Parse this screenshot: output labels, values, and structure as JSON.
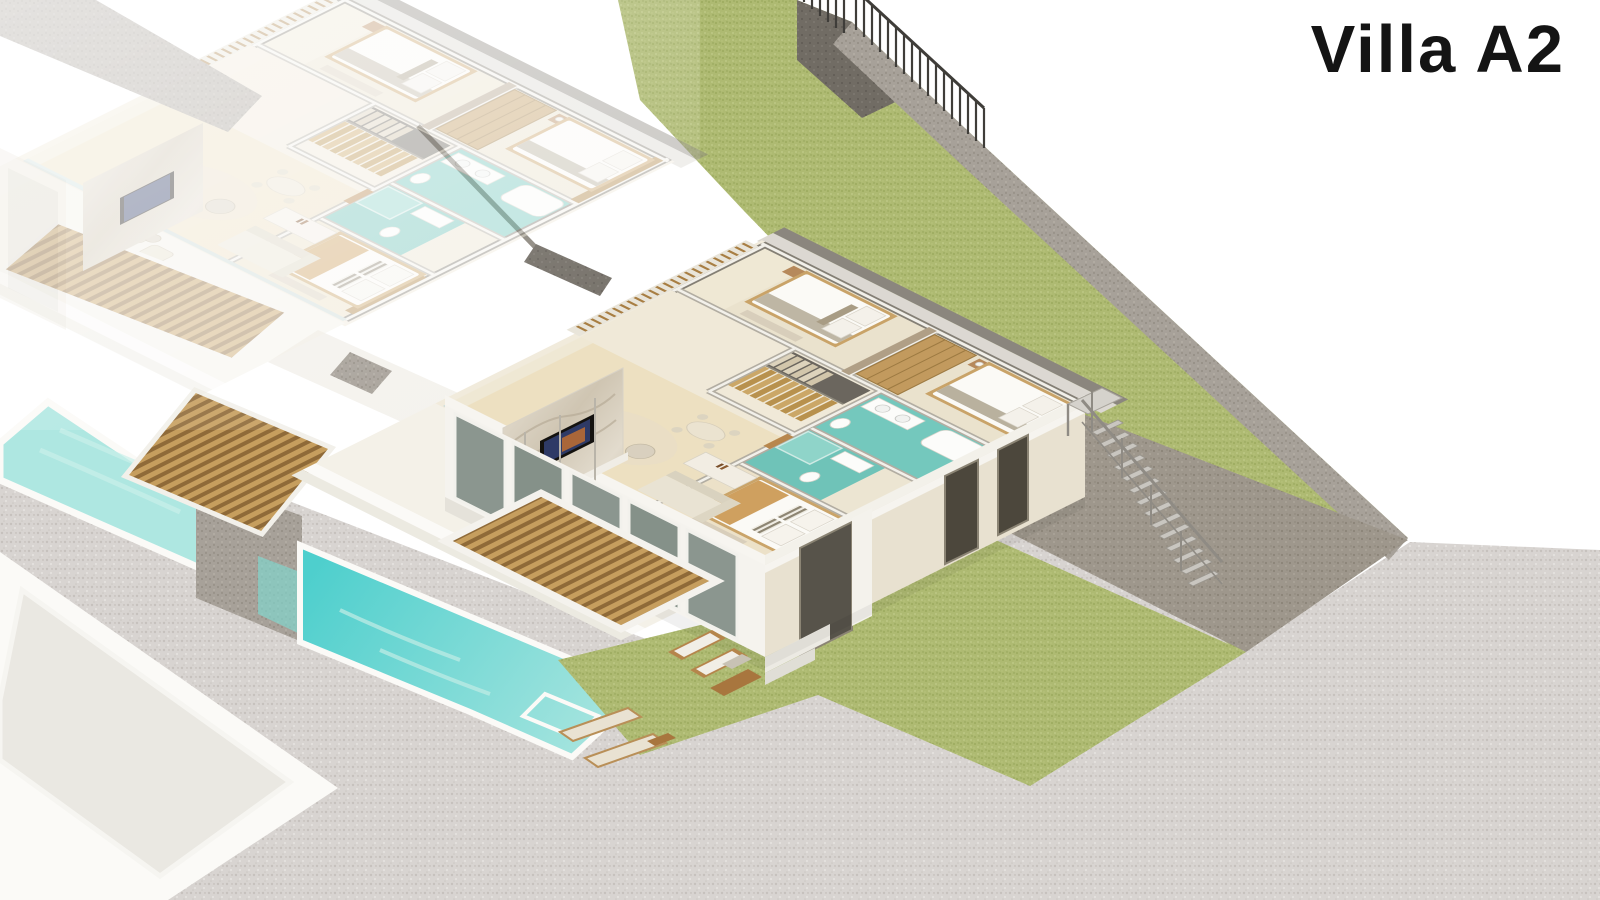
{
  "title": {
    "text": "Villa A2"
  },
  "scene": {
    "type": "isometric-architectural-cutaway",
    "subject": "Two-storey villa upper-floor cutaway plan with garden terraces, pools and sun deck",
    "neighbor_note": "identical neighbouring villa rendered faded at upper left"
  },
  "palette": {
    "background": "#ffffff",
    "title_text": "#141414",
    "grass": "#aeba72",
    "grass_speckle": "#9cab5e",
    "concrete_ground": "#d8d4d1",
    "boundary_wall": "#a7a199",
    "boundary_wall_dark": "#716c64",
    "retaining_wall": "#9e978c",
    "fence_metal": "#3f3d39",
    "pool_pale": "#aee7e1",
    "pool_teal": "#4ecfcd",
    "bathroom_teal": "#74c8bd",
    "floor_cream": "#efe8d4",
    "floor_living": "#ede0c1",
    "wall_cut_grey": "#b2ada2",
    "wall_cut_dark": "#847f75",
    "wood_slats": "#b68c4e",
    "wood_dark": "#8f6a38",
    "bed_wood": "#c9a368",
    "facade_cream": "#e8e1d0",
    "white_structure": "#f7f5f0",
    "glass_green": "#7d8a82",
    "metal_stair": "#c9c6c0",
    "marble": "#d8cfc0",
    "linen": "#fbfaf6"
  },
  "rooms": [
    {
      "name": "living-room"
    },
    {
      "name": "tv-marble-wall"
    },
    {
      "name": "staircase"
    },
    {
      "name": "hallway"
    },
    {
      "name": "bedroom-1"
    },
    {
      "name": "bedroom-2"
    },
    {
      "name": "master-bedroom"
    },
    {
      "name": "bathroom-1"
    },
    {
      "name": "bathroom-2"
    },
    {
      "name": "wardrobe"
    },
    {
      "name": "kitchen-dining"
    },
    {
      "name": "terrace"
    }
  ],
  "exterior": [
    {
      "name": "garden-lawn-upper"
    },
    {
      "name": "garden-lawn-lower"
    },
    {
      "name": "boundary-fence"
    },
    {
      "name": "boundary-wall"
    },
    {
      "name": "retaining-wall"
    },
    {
      "name": "external-staircase"
    },
    {
      "name": "swimming-pool-neighbor"
    },
    {
      "name": "swimming-pool-main"
    },
    {
      "name": "sun-deck"
    },
    {
      "name": "sun-loungers",
      "count": 2
    },
    {
      "name": "outdoor-lounge-set"
    },
    {
      "name": "timber-pergola-deck"
    },
    {
      "name": "timber-bridge-deck"
    },
    {
      "name": "neighbor-villa-faded"
    },
    {
      "name": "neighbor-roof-terrace"
    },
    {
      "name": "concrete-terrain"
    }
  ]
}
